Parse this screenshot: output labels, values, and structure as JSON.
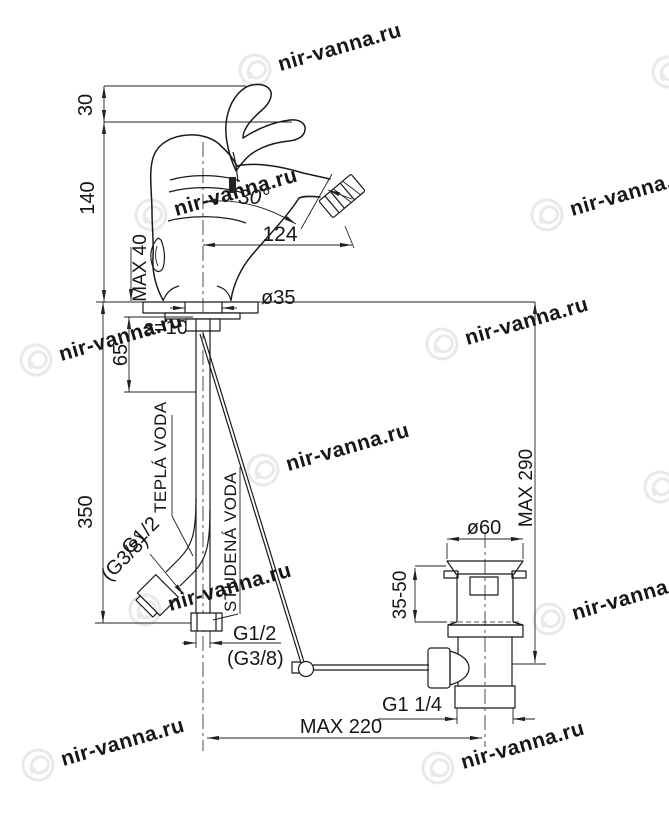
{
  "watermark": {
    "text": "nir-vanna.ru",
    "color": "#e9e9e9"
  },
  "colors": {
    "line": "#1a1a1a",
    "dim_line": "#222222",
    "background": "#ffffff"
  },
  "dimensions": {
    "handle_rise": "30",
    "body_height": "140",
    "supply_length": "350",
    "max_deck_thickness": "MAX 40",
    "spray_angle": "30°",
    "spout_reach": "124",
    "mount_hole_dia": "ø35",
    "plate_thickness": "s=10",
    "shank_length": "65",
    "max_height_to_rod": "MAX 290",
    "waste_flange_dia": "ø60",
    "clamping_range": "35-50",
    "waste_thread": "G1 1/4",
    "max_rod_reach": "MAX 220"
  },
  "connections": {
    "hot_label": "TEPLÁ VODA",
    "cold_label": "STUDENÁ VODA",
    "hot_thread": "G1/2",
    "hot_thread_alt": "(G3/8)",
    "cold_thread": "G1/2",
    "cold_thread_alt": "(G3/8)"
  }
}
